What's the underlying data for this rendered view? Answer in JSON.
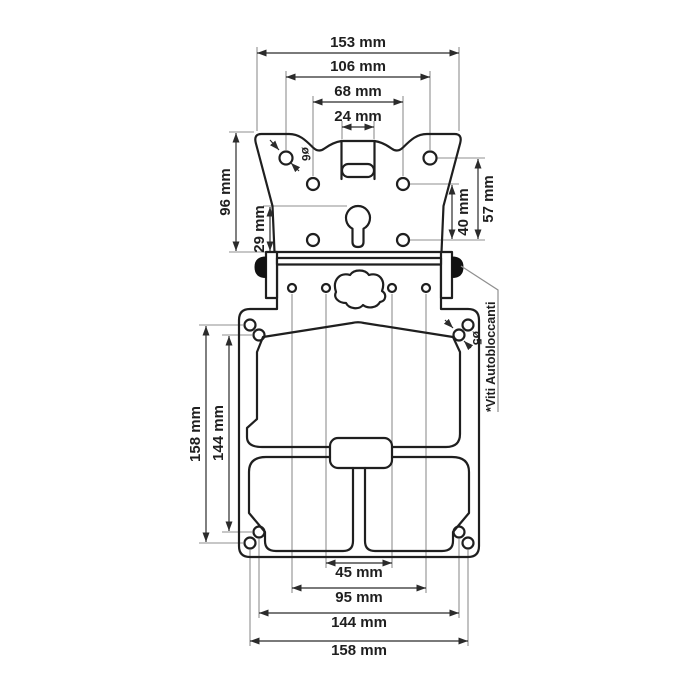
{
  "drawing": {
    "type": "technical-dimension-drawing",
    "units": "mm",
    "note": "*Viti Autobloccanti",
    "holes": {
      "d6": "ø6",
      "d5": "ø5"
    },
    "dims": {
      "top": {
        "w153": "153 mm",
        "w106": "106 mm",
        "w68": "68 mm",
        "w24": "24 mm"
      },
      "left_upper": {
        "h96": "96 mm",
        "h29": "29 mm"
      },
      "right_upper": {
        "h40": "40 mm",
        "h57": "57 mm"
      },
      "left_lower": {
        "h158": "158 mm",
        "h144": "144 mm"
      },
      "bottom": {
        "w45": "45 mm",
        "w95": "95 mm",
        "w144": "144 mm",
        "w158": "158 mm"
      }
    },
    "dimensions_mm": {
      "bracket_widths": [
        153,
        106,
        68,
        24
      ],
      "bracket_heights": [
        96,
        29,
        40,
        57
      ],
      "plate_heights": [
        158,
        144
      ],
      "plate_widths": [
        45,
        95,
        144,
        158
      ],
      "hole_diameters": [
        6,
        5
      ]
    },
    "colors": {
      "line": "#1f1f1f",
      "dim": "#2b2b2b",
      "ext": "#8f8f8f",
      "bg": "#ffffff"
    }
  }
}
